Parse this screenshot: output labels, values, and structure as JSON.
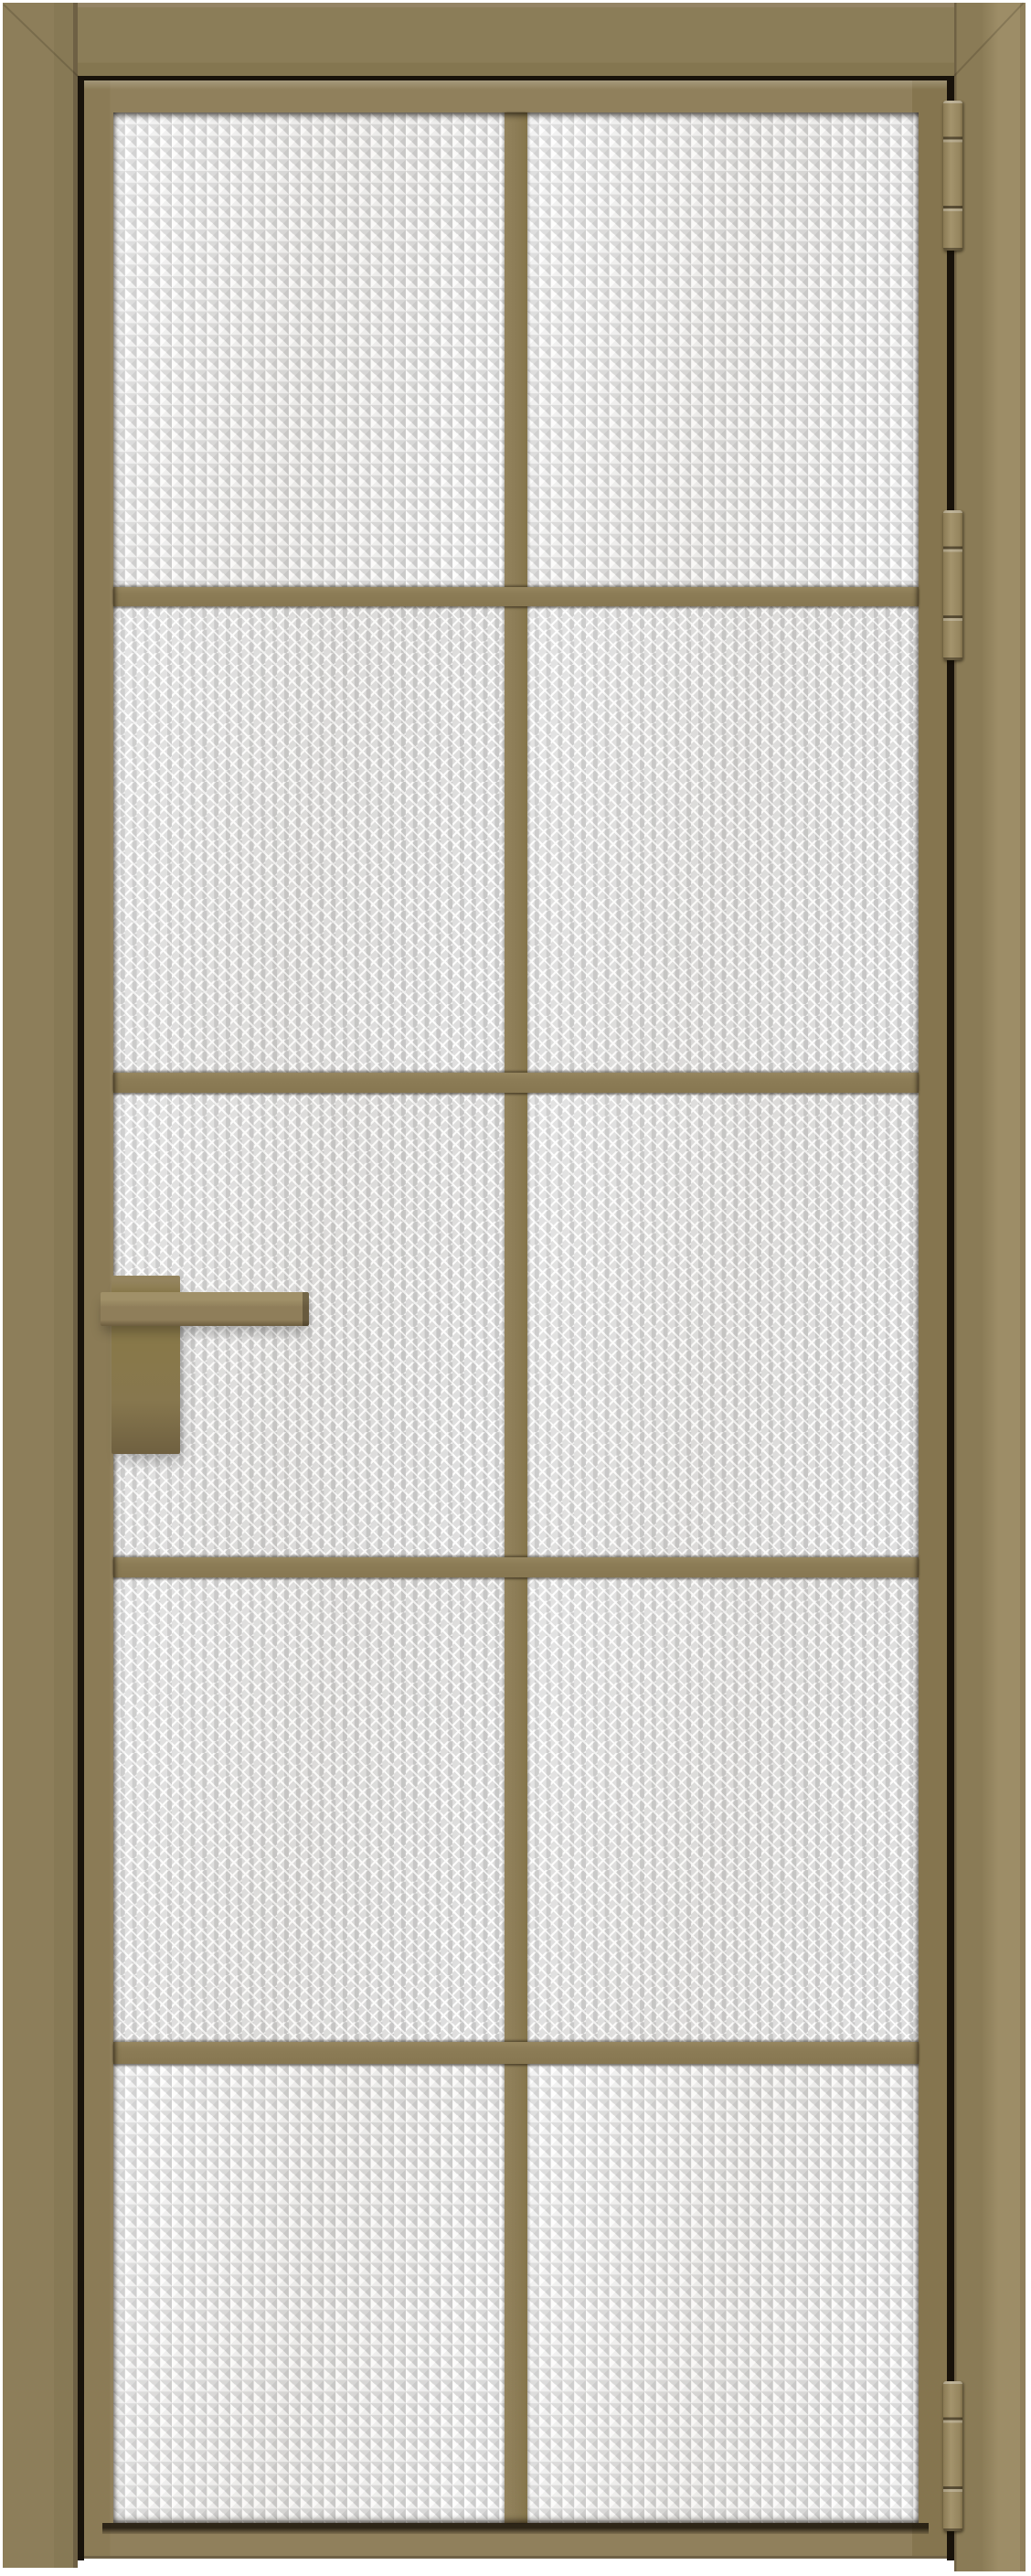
{
  "scene": {
    "type": "product-render",
    "description": "Front view of a closed single-leaf interior glass door with a bronze-tan aluminum frame",
    "background_color": "#ffffff"
  },
  "door": {
    "style": "Loft / French grid glass door, 2 columns x 5 rows of panes",
    "frame_color": "#8b7c57",
    "leaf_color": "#90805c",
    "muntin_color": "#8c7c56",
    "gap_shadow_color": "#18120a",
    "glass": {
      "texture": "prismatic textured glass",
      "base_color": "#e2e2e2",
      "highlight_color": "#ffffff",
      "shadow_color": "#c7c7c7",
      "columns": 2,
      "rows": 5,
      "pane_count": 10
    },
    "handle": {
      "label": "Square lever handle on rectangular backplate",
      "side": "left",
      "color": "#8f7e5a"
    },
    "hinges": {
      "label": "Barrel hinge",
      "count": 3,
      "side": "right",
      "color": "#9a8a63",
      "positions": [
        "top",
        "upper-middle",
        "bottom"
      ]
    }
  },
  "parts": {
    "frame_top": "Door frame — top member",
    "frame_left": "Door frame — left jamb",
    "frame_right": "Door frame — right jamb (hinge side)",
    "leaf": "Door leaf",
    "pane": "Textured glass pane",
    "muntin_v": "Vertical glazing bar",
    "muntin_h": "Horizontal glazing bar",
    "handle_plate": "Handle backplate",
    "handle_lever": "Lever handle",
    "hinge": "Hinge",
    "gap": "Shadow gap between leaf and frame"
  }
}
